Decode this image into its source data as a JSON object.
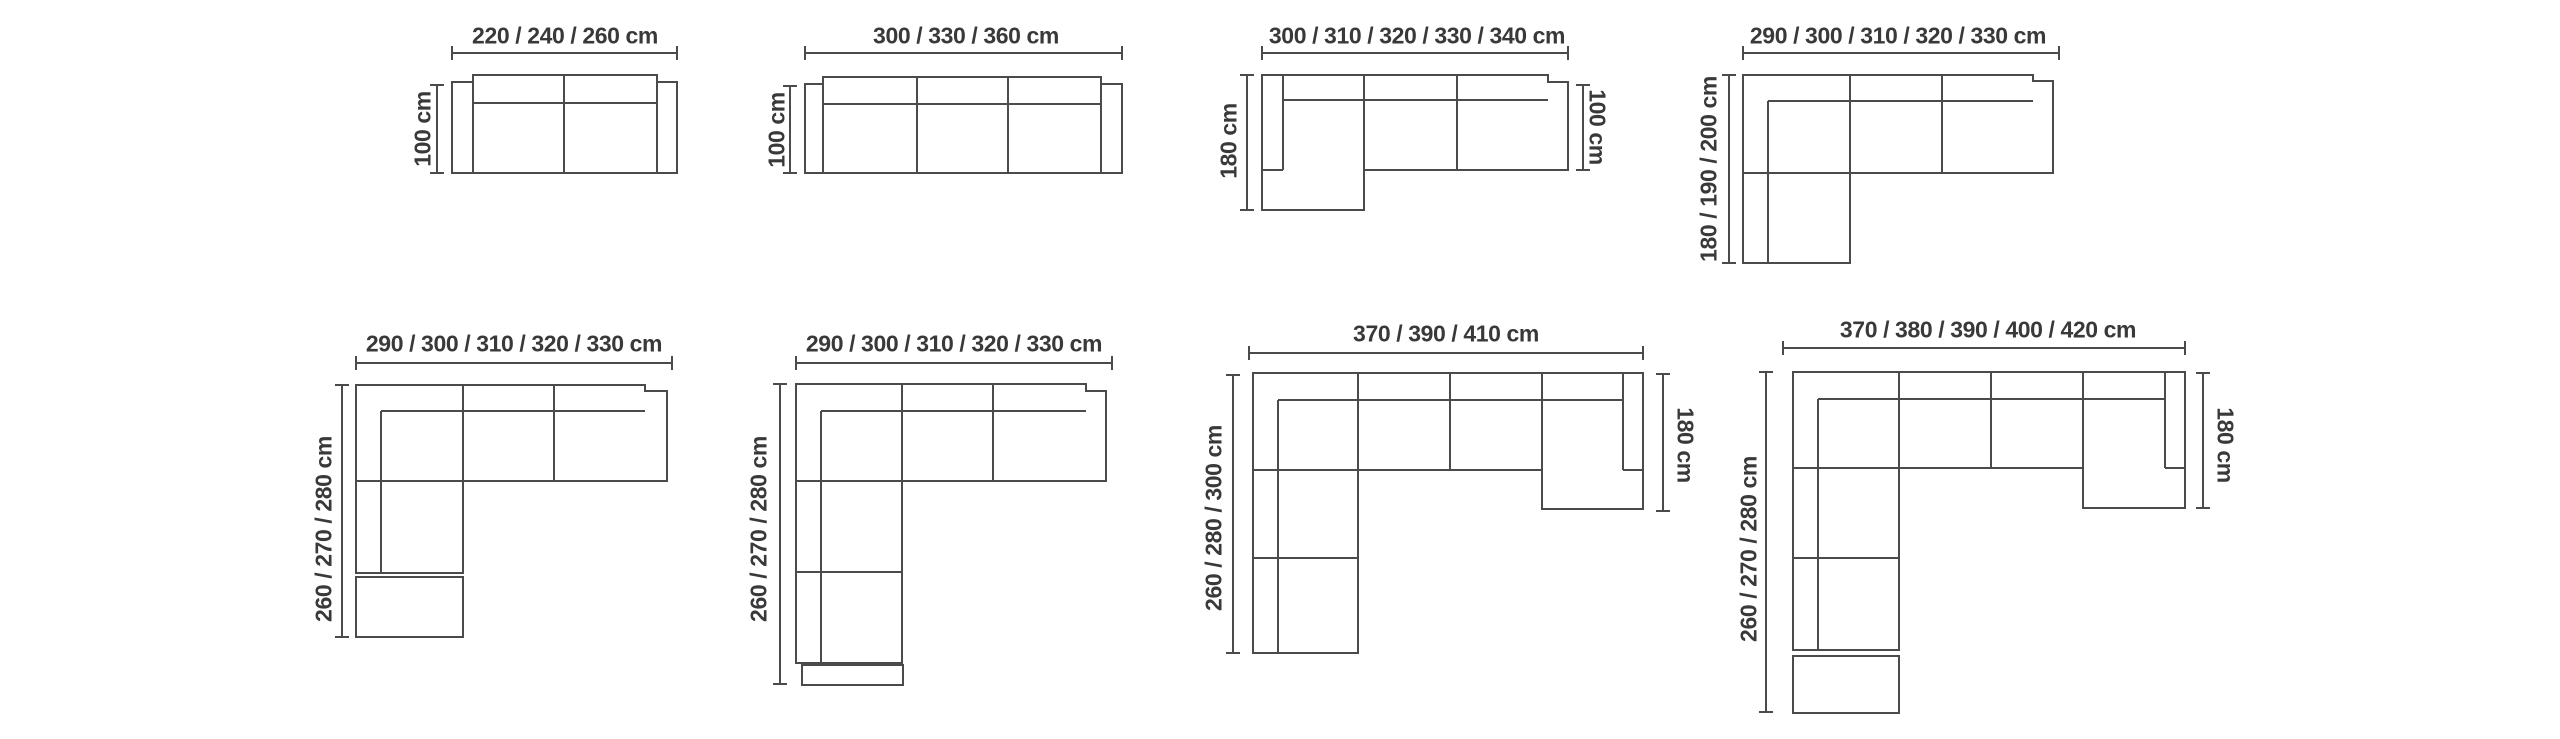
{
  "page": {
    "background": "#ffffff",
    "line_color": "#4b4b4d",
    "text_color": "#39393b"
  },
  "diagrams": [
    {
      "name": "two-seater-sofa",
      "width_label": "220 / 240 / 260 cm",
      "depth_label": "100 cm"
    },
    {
      "name": "three-seater-sofa",
      "width_label": "300 / 330 / 360 cm",
      "depth_label": "100 cm"
    },
    {
      "name": "chaise-sofa-left",
      "width_label": "300 / 310 / 320 / 330 / 340 cm",
      "height_label": "180 cm",
      "depth_label": "100 cm"
    },
    {
      "name": "corner-sofa",
      "width_label": "290 / 300 / 310 / 320 / 330 cm",
      "height_label": "180 / 190 / 200 cm"
    },
    {
      "name": "corner-sofa-with-ottoman",
      "width_label": "290 / 300 / 310 / 320 / 330 cm",
      "height_label": "260 / 270 / 280 cm"
    },
    {
      "name": "corner-sofa-long-chaise",
      "width_label": "290 / 300 / 310 / 320 / 330 cm",
      "height_label": "260 / 270 / 280 cm"
    },
    {
      "name": "u-shape-sofa",
      "width_label": "370 / 390 / 410 cm",
      "height_label": "260 / 280 / 300 cm",
      "depth_label": "180 cm"
    },
    {
      "name": "u-shape-sofa-with-ottoman",
      "width_label": "370 / 380 / 390 / 400 / 420 cm",
      "height_label": "260 / 270 / 280 cm",
      "depth_label": "180 cm"
    }
  ]
}
